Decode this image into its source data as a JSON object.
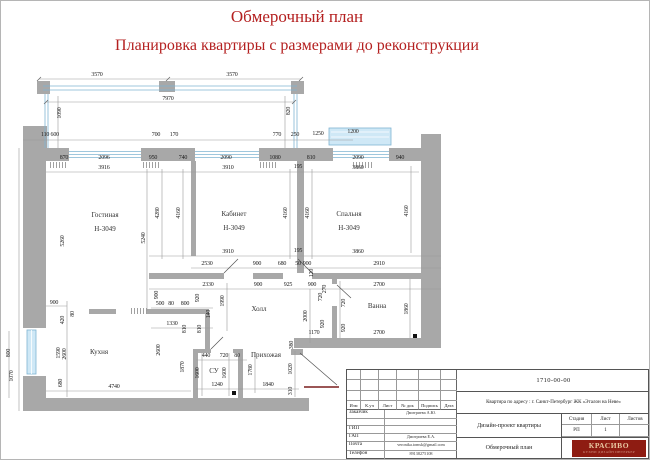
{
  "page": {
    "title": "Обмерочный план",
    "subtitle": "Планировка квартиры с размерами до реконструкции"
  },
  "colors": {
    "accent_red": "#b42020",
    "wall_gray": "#a8a8a8",
    "window_blue": "#cfe8f6",
    "logo_red": "#8e1c12"
  },
  "plan": {
    "labels": [
      {
        "t": "3570",
        "x": 96,
        "y": 74
      },
      {
        "t": "3570",
        "x": 231,
        "y": 74
      },
      {
        "t": "7970",
        "x": 167,
        "y": 98
      },
      {
        "t": "1090",
        "x": 59,
        "y": 112,
        "v": 1
      },
      {
        "t": "820",
        "x": 288,
        "y": 110,
        "v": 1
      },
      {
        "t": "110 600",
        "x": 49,
        "y": 134
      },
      {
        "t": "700",
        "x": 155,
        "y": 134
      },
      {
        "t": "170",
        "x": 173,
        "y": 134
      },
      {
        "t": "770",
        "x": 276,
        "y": 134
      },
      {
        "t": "250",
        "x": 294,
        "y": 134
      },
      {
        "t": "1250",
        "x": 317,
        "y": 133
      },
      {
        "t": "1200",
        "x": 352,
        "y": 131
      },
      {
        "t": "870",
        "x": 63,
        "y": 157
      },
      {
        "t": "2096",
        "x": 103,
        "y": 157
      },
      {
        "t": "950",
        "x": 152,
        "y": 157
      },
      {
        "t": "740",
        "x": 182,
        "y": 157
      },
      {
        "t": "2090",
        "x": 225,
        "y": 157
      },
      {
        "t": "1080",
        "x": 274,
        "y": 157
      },
      {
        "t": "810",
        "x": 310,
        "y": 157
      },
      {
        "t": "2090",
        "x": 357,
        "y": 157
      },
      {
        "t": "940",
        "x": 399,
        "y": 157
      },
      {
        "t": "3916",
        "x": 103,
        "y": 167
      },
      {
        "t": "3910",
        "x": 227,
        "y": 167
      },
      {
        "t": "3860",
        "x": 357,
        "y": 167
      },
      {
        "t": "195",
        "x": 297,
        "y": 166
      },
      {
        "t": "5260",
        "x": 62,
        "y": 240,
        "v": 1
      },
      {
        "t": "5240",
        "x": 143,
        "y": 237,
        "v": 1
      },
      {
        "t": "4280",
        "x": 157,
        "y": 212,
        "v": 1
      },
      {
        "t": "4160",
        "x": 178,
        "y": 212,
        "v": 1
      },
      {
        "t": "4160",
        "x": 285,
        "y": 212,
        "v": 1
      },
      {
        "t": "4160",
        "x": 307,
        "y": 212,
        "v": 1
      },
      {
        "t": "4160",
        "x": 406,
        "y": 210,
        "v": 1
      },
      {
        "t": "3910",
        "x": 227,
        "y": 251
      },
      {
        "t": "3860",
        "x": 357,
        "y": 251
      },
      {
        "t": "195",
        "x": 297,
        "y": 250
      },
      {
        "t": "2530",
        "x": 206,
        "y": 263
      },
      {
        "t": "900",
        "x": 256,
        "y": 263
      },
      {
        "t": "680",
        "x": 281,
        "y": 263
      },
      {
        "t": "50",
        "x": 297,
        "y": 263
      },
      {
        "t": "900",
        "x": 306,
        "y": 263
      },
      {
        "t": "2910",
        "x": 378,
        "y": 263
      },
      {
        "t": "120",
        "x": 311,
        "y": 272,
        "v": 1
      },
      {
        "t": "2330",
        "x": 207,
        "y": 284
      },
      {
        "t": "900",
        "x": 257,
        "y": 284
      },
      {
        "t": "925",
        "x": 287,
        "y": 284
      },
      {
        "t": "900",
        "x": 311,
        "y": 284
      },
      {
        "t": "270",
        "x": 324,
        "y": 288,
        "v": 1
      },
      {
        "t": "2700",
        "x": 378,
        "y": 284
      },
      {
        "t": "720",
        "x": 320,
        "y": 296,
        "v": 1
      },
      {
        "t": "720",
        "x": 343,
        "y": 302,
        "v": 1
      },
      {
        "t": "920",
        "x": 322,
        "y": 323,
        "v": 1
      },
      {
        "t": "920",
        "x": 343,
        "y": 327,
        "v": 1
      },
      {
        "t": "1170",
        "x": 313,
        "y": 332
      },
      {
        "t": "2700",
        "x": 378,
        "y": 332
      },
      {
        "t": "1860",
        "x": 406,
        "y": 308,
        "v": 1
      },
      {
        "t": "900",
        "x": 156,
        "y": 294,
        "v": 1
      },
      {
        "t": "500",
        "x": 159,
        "y": 303
      },
      {
        "t": "80",
        "x": 170,
        "y": 303
      },
      {
        "t": "800",
        "x": 184,
        "y": 303
      },
      {
        "t": "920",
        "x": 197,
        "y": 297,
        "v": 1
      },
      {
        "t": "140",
        "x": 208,
        "y": 313,
        "v": 1
      },
      {
        "t": "1330",
        "x": 171,
        "y": 323
      },
      {
        "t": "810",
        "x": 184,
        "y": 328,
        "v": 1
      },
      {
        "t": "810",
        "x": 199,
        "y": 328,
        "v": 1
      },
      {
        "t": "1990",
        "x": 222,
        "y": 300,
        "v": 1
      },
      {
        "t": "2000",
        "x": 305,
        "y": 315,
        "v": 1
      },
      {
        "t": "380",
        "x": 291,
        "y": 344,
        "v": 1
      },
      {
        "t": "440",
        "x": 205,
        "y": 355
      },
      {
        "t": "720",
        "x": 223,
        "y": 355
      },
      {
        "t": "80",
        "x": 236,
        "y": 355
      },
      {
        "t": "1780",
        "x": 250,
        "y": 369,
        "v": 1
      },
      {
        "t": "1020",
        "x": 290,
        "y": 368,
        "v": 1
      },
      {
        "t": "1600",
        "x": 197,
        "y": 372,
        "v": 1
      },
      {
        "t": "1600",
        "x": 224,
        "y": 372,
        "v": 1
      },
      {
        "t": "1240",
        "x": 216,
        "y": 384
      },
      {
        "t": "1840",
        "x": 267,
        "y": 384
      },
      {
        "t": "310",
        "x": 290,
        "y": 390,
        "v": 1
      },
      {
        "t": "1870",
        "x": 182,
        "y": 366,
        "v": 1
      },
      {
        "t": "2600",
        "x": 158,
        "y": 349,
        "v": 1
      },
      {
        "t": "900",
        "x": 53,
        "y": 302
      },
      {
        "t": "420",
        "x": 62,
        "y": 319,
        "v": 1
      },
      {
        "t": "80",
        "x": 72,
        "y": 313,
        "v": 1
      },
      {
        "t": "1590",
        "x": 58,
        "y": 352,
        "v": 1
      },
      {
        "t": "2600",
        "x": 64,
        "y": 353,
        "v": 1
      },
      {
        "t": "680",
        "x": 60,
        "y": 382,
        "v": 1
      },
      {
        "t": "800",
        "x": 8,
        "y": 352,
        "v": 1
      },
      {
        "t": "1070",
        "x": 11,
        "y": 375,
        "v": 1
      },
      {
        "t": "4740",
        "x": 113,
        "y": 386
      },
      {
        "t": "Гостиная",
        "x": 104,
        "y": 214,
        "k": "room"
      },
      {
        "t": "Н-3049",
        "x": 104,
        "y": 228,
        "k": "room"
      },
      {
        "t": "Кабинет",
        "x": 233,
        "y": 213,
        "k": "room"
      },
      {
        "t": "Н-3049",
        "x": 233,
        "y": 227,
        "k": "room"
      },
      {
        "t": "Спальня",
        "x": 348,
        "y": 213,
        "k": "room"
      },
      {
        "t": "Н-3049",
        "x": 348,
        "y": 227,
        "k": "room"
      },
      {
        "t": "Кухня",
        "x": 98,
        "y": 351,
        "k": "room"
      },
      {
        "t": "Холл",
        "x": 258,
        "y": 308,
        "k": "room"
      },
      {
        "t": "Прихожая",
        "x": 265,
        "y": 354,
        "k": "room"
      },
      {
        "t": "СУ",
        "x": 213,
        "y": 370,
        "k": "room"
      },
      {
        "t": "Ванна",
        "x": 376,
        "y": 305,
        "k": "room"
      }
    ]
  },
  "stamp": {
    "doc_number": "1710-00-00",
    "address": "Квартира по адресу : г. Санкт-Петербург  ЖК «Эталон на Неве»",
    "header_cols": [
      "Изм",
      "К.уч",
      "Лист",
      "№ док",
      "Подпись",
      "Дата"
    ],
    "rows": [
      {
        "label": "Заказчик",
        "value": "Дмитриева А.Ю."
      },
      {
        "label": "",
        "value": ""
      },
      {
        "label": "ГИП",
        "value": ""
      },
      {
        "label": "ГАП",
        "value": "Дмитриева Е.А."
      },
      {
        "label": "Почта",
        "value": "veronika.tomsk@gmail.com"
      },
      {
        "label": "Телефон",
        "value": "89138275108"
      }
    ],
    "project": "Дизайн-проект квартиры",
    "drawing": "Обмерочный план",
    "stage": {
      "label": "Стадия",
      "value": "РП"
    },
    "sheet": {
      "label": "Лист",
      "value": "1"
    },
    "sheets": {
      "label": "Листов",
      "value": ""
    },
    "logo": {
      "name": "КРАСИВО",
      "tagline": "КУХНИ ДИЗАЙН ИНТЕРЬЕР"
    }
  }
}
